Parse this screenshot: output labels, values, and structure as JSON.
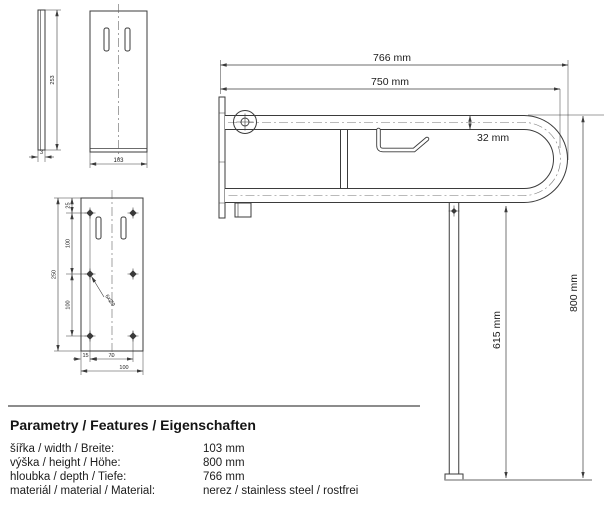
{
  "drawing": {
    "side_view": {
      "height": "253",
      "thickness": "3"
    },
    "front_view": {
      "width": "103"
    },
    "plate_view": {
      "top_offset": "25",
      "upper_spacing": "100",
      "overall_height": "250",
      "lower_spacing": "100",
      "edge_offset": "15",
      "hole_spacing": "70",
      "overall_width": "100",
      "holes_note": "6xØ9"
    },
    "assembly_view": {
      "overall_length": "766 mm",
      "bar_length": "750 mm",
      "tube_diameter": "32 mm",
      "leg_height": "615 mm",
      "overall_height": "800 mm"
    }
  },
  "specs": {
    "title": "Parametry / Features / Eigenschaften",
    "rows": [
      {
        "label": "šířka / width / Breite:",
        "value": "103 mm"
      },
      {
        "label": "výška / height / Höhe:",
        "value": "800 mm"
      },
      {
        "label": "hloubka / depth / Tiefe:",
        "value": "766 mm"
      },
      {
        "label": "materiál / material / Material:",
        "value": "nerez / stainless steel / rostfrei"
      }
    ]
  }
}
